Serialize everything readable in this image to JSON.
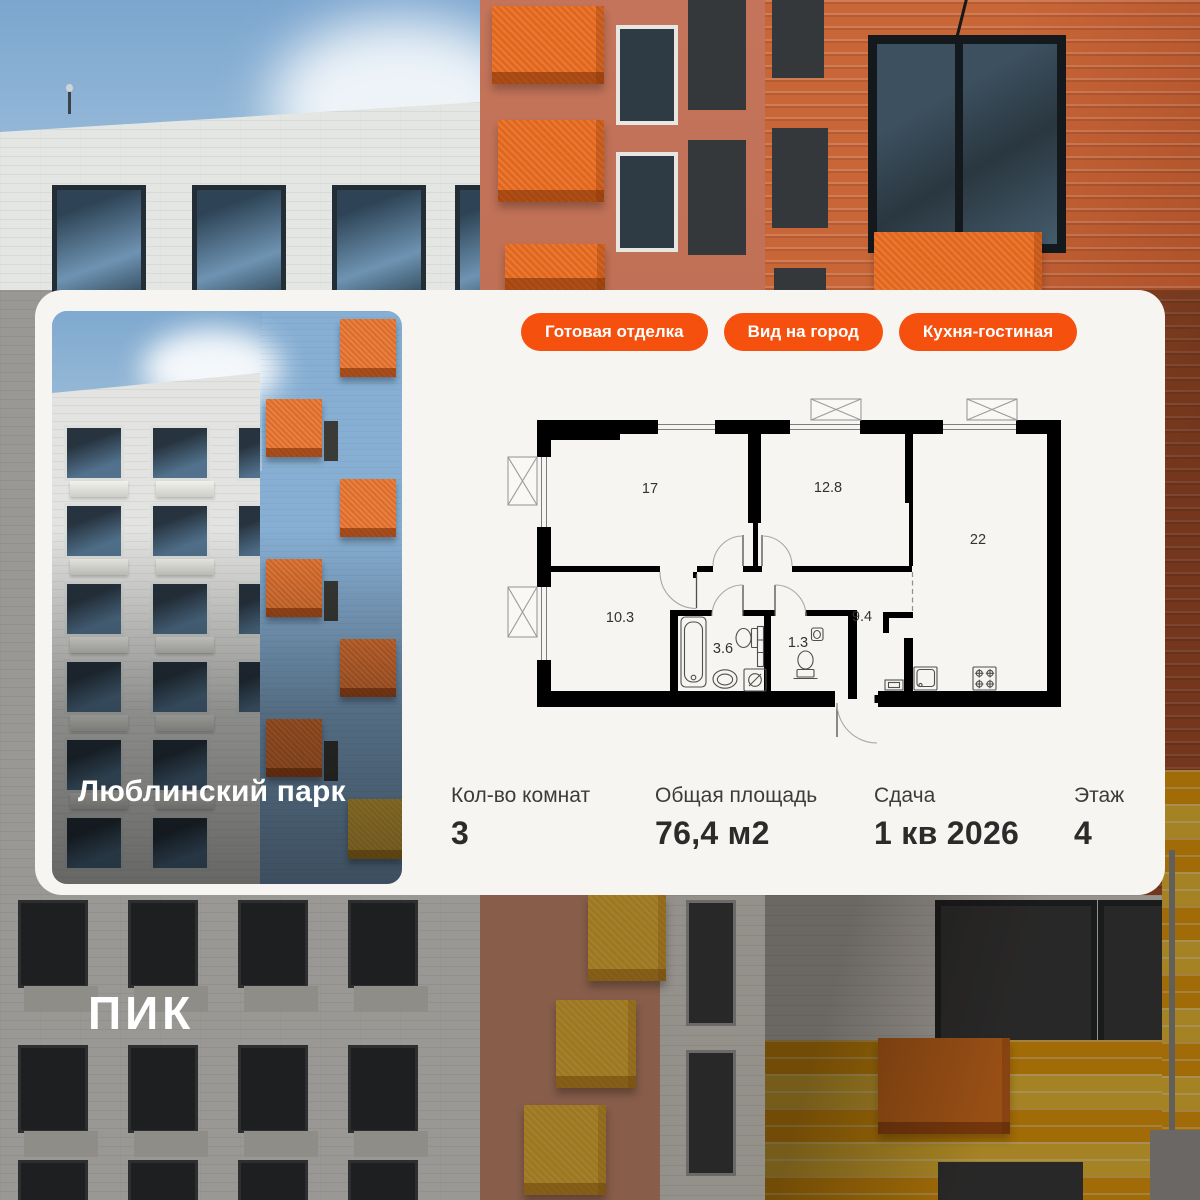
{
  "logo": {
    "text": "ПИК"
  },
  "card": {
    "photo": {
      "project_name": "Люблинский парк"
    },
    "badges": [
      {
        "label": "Готовая отделка"
      },
      {
        "label": "Вид на город"
      },
      {
        "label": "Кухня-гостиная"
      }
    ],
    "floor_plan": {
      "rooms": [
        {
          "name": "room-1",
          "area": "17"
        },
        {
          "name": "room-2",
          "area": "12.8"
        },
        {
          "name": "kitchen-living",
          "area": "22"
        },
        {
          "name": "room-3",
          "area": "10.3"
        },
        {
          "name": "bathroom",
          "area": "3.6"
        },
        {
          "name": "wc",
          "area": "1.3"
        },
        {
          "name": "hallway",
          "area": "9.4"
        }
      ]
    },
    "specs": [
      {
        "label": "Кол-во комнат",
        "value": "3"
      },
      {
        "label": "Общая площадь",
        "value": "76,4 м2"
      },
      {
        "label": "Сдача",
        "value": "1 кв 2026"
      },
      {
        "label": "Этаж",
        "value": "4"
      }
    ]
  },
  "colors": {
    "accent": "#F6500F",
    "card_bg": "#F7F5F1",
    "wall": "#000000",
    "title_text": "#FFFFFF",
    "spec_text": "#2B2B2B"
  }
}
